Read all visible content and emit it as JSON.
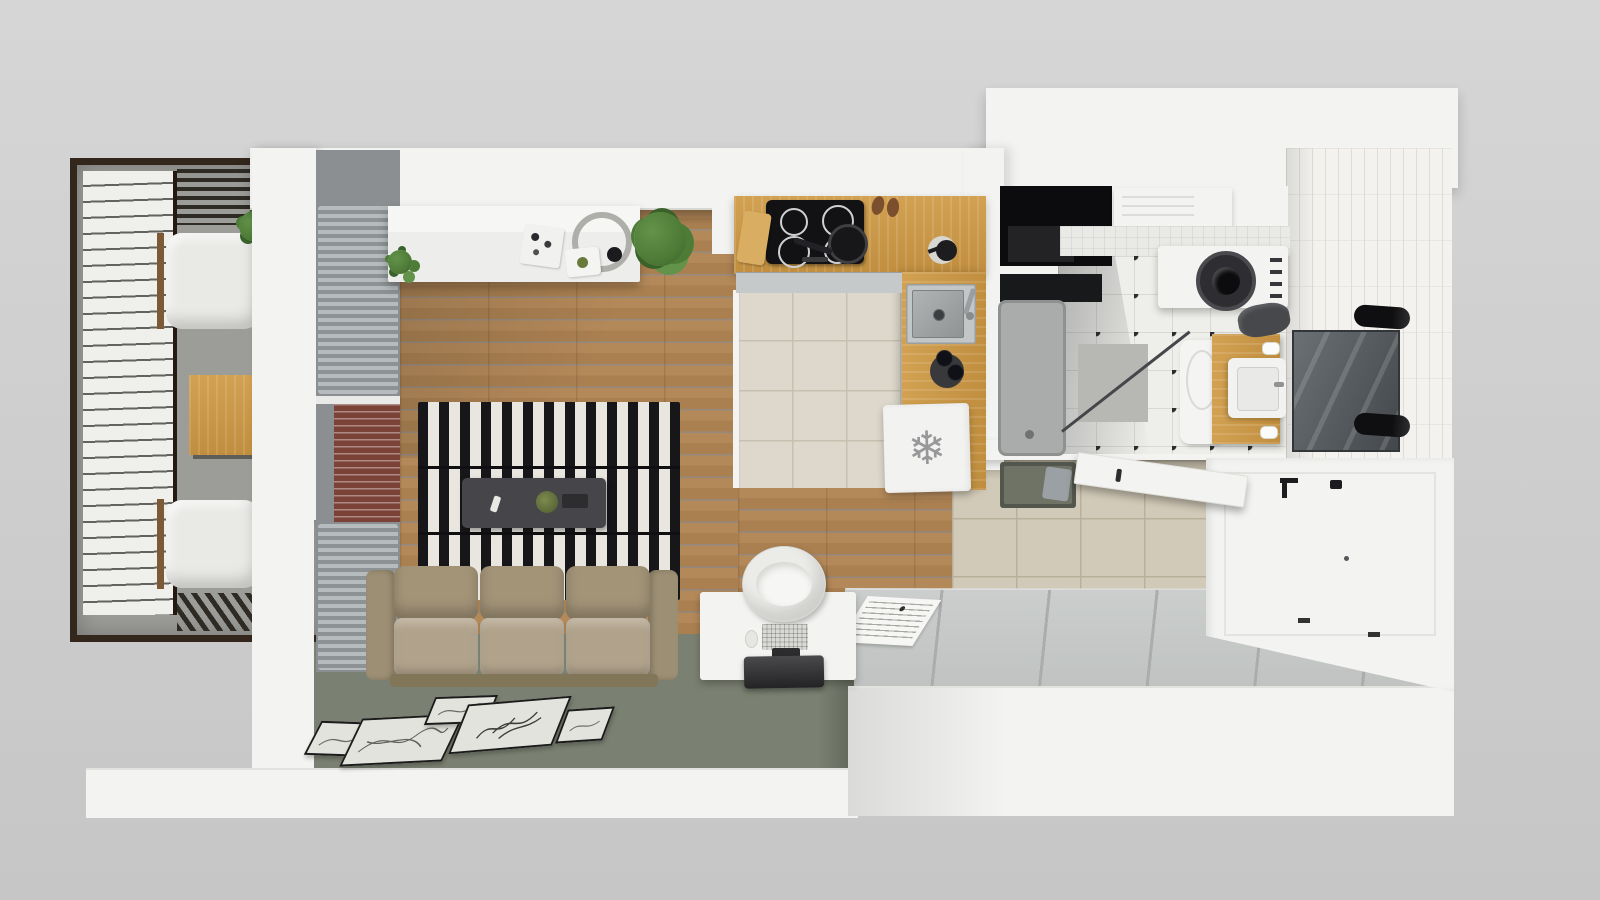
{
  "scene": {
    "title": "Studio apartment - top-down 3D floor plan render",
    "style": "photorealistic axonometric dollhouse view",
    "rooms": [
      "balcony",
      "living-room",
      "kitchen",
      "bathroom",
      "hallway",
      "sleeping-area"
    ]
  },
  "icons": {
    "freezer_glyph": "❄"
  },
  "palette": {
    "bg1": "#d6d6d6",
    "bg2": "#c6c6c6",
    "wall": "#f3f3f1",
    "wood1": "#b4895a",
    "wood2": "#aa8051",
    "counter1": "#d2a152",
    "counter2": "#c08e3e",
    "tileK": "#ddd8cb",
    "tileKline": "#c6c0b1",
    "tileH": "#d2cab8",
    "tileHline": "#b9b09c",
    "bathT": "#eeeeea",
    "bathLine": "#d9d9d4",
    "bathDot": "#2c2c2e",
    "wallTile": "#f3f2ee",
    "wallTileLine": "#dddcd6",
    "rugGreen": "#7b8172",
    "stripeD": "#17171a",
    "stripeL": "#e9e6df",
    "sofaBack": "#a39478",
    "sofaSeat": "#b1a38b",
    "sofaArm": "#9d8f74",
    "sofaBase": "#827659",
    "tableDark": "#46464a",
    "plat1": "#cbcecd",
    "plat2": "#bfc2c1",
    "platseam": "#aaadac",
    "balcFloor": "#9c9d99",
    "pergola": "#2e2a24",
    "awn": "#efefec",
    "awnline": "#62625e",
    "frameBrown": "#33261d",
    "rad1": "#b6bbbd",
    "rad2": "#8d9294",
    "curtain": "#7b4238",
    "plantA": "#4e7c37",
    "plantB": "#39622b",
    "plantC": "#63924a",
    "steel1": "#b0b4b5",
    "steel2": "#8f9394",
    "cushion": "#e9e9e6",
    "bench": "#6e7366",
    "towel": "#47484c",
    "snow": "#98989a",
    "paper": "#e3e3dd",
    "glass1": "#6a7074",
    "glass2": "#44484c"
  },
  "inventory": {
    "balcony": [
      "lounge-chair",
      "lounge-chair",
      "wooden-side-table",
      "potted-plant",
      "slatted-pergola",
      "striped-awning"
    ],
    "living_room": [
      "white-sideboard",
      "table-lamp",
      "decor-tray",
      "small-plant",
      "large-plant",
      "striped-rug",
      "dark-coffee-table",
      "three-seat-sofa",
      "green-area-rug",
      "five-picture-frames",
      "radiators",
      "red-curtain"
    ],
    "kitchen": [
      "l-shaped-oak-counter",
      "induction-cooktop",
      "frying-pan",
      "cutting-board",
      "slippers",
      "coffee-pot",
      "steel-sink",
      "wine-bottles",
      "freezer-fridge"
    ],
    "bathroom": [
      "storage-niche",
      "towel-shelf",
      "washing-machine",
      "shower-tray",
      "glass-screen",
      "bath-mat",
      "toilet",
      "wood-vanity-sink",
      "dark-towel",
      "toilet-rolls",
      "mirror",
      "two-wall-sconces"
    ],
    "hallway": [
      "entry-bench",
      "gray-pillow",
      "entrance-door",
      "beige-floor-tiles"
    ],
    "sleeping_area": [
      "platform-bed-base",
      "assembly-sheet",
      "built-in-wardrobe"
    ]
  },
  "counts": {
    "picture_frames": 5,
    "cooktop_burners": 4,
    "sofa_seats": 3
  }
}
